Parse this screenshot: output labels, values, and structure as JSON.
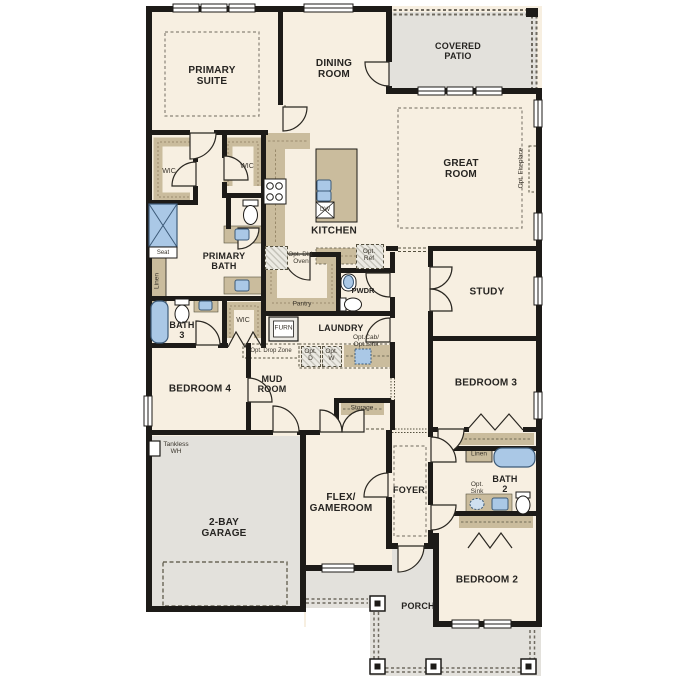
{
  "plan_title": "Single-story floor plan",
  "colors": {
    "wall": "#1d1b18",
    "floor": "#f7efe1",
    "outdoor": "#e3e1dc",
    "cabinet": "#cabc9d",
    "fixture_blue": "#aac8e6"
  },
  "rooms": {
    "primary_suite": "PRIMARY\nSUITE",
    "dining_room": "DINING\nROOM",
    "covered_patio": "COVERED\nPATIO",
    "great_room": "GREAT\nROOM",
    "kitchen": "KITCHEN",
    "primary_bath": "PRIMARY\nBATH",
    "bath_3": "BATH\n3",
    "bedroom_4": "BEDROOM 4",
    "mud_room": "MUD\nROOM",
    "laundry": "LAUNDRY",
    "pwdr": "PWDR",
    "study": "STUDY",
    "bedroom_3": "BEDROOM 3",
    "flex_gameroom": "FLEX/\nGAMEROOM",
    "foyer": "FOYER",
    "bath_2": "BATH\n2",
    "bedroom_2": "BEDROOM 2",
    "garage": "2-BAY\nGARAGE",
    "porch": "PORCH"
  },
  "closets": {
    "wic_primary_left": "WIC",
    "wic_primary_right": "WIC",
    "wic_bedroom_4": "WIC",
    "linen_primary": "Linen",
    "linen_bath_2": "Linen",
    "storage": "Storage",
    "pantry": "Pantry"
  },
  "annotations": {
    "seat": "Seat",
    "furnace": "FURN",
    "dishwasher": "DW",
    "tankless_wh": "Tankless\nWH",
    "opt_dbl_oven": "Opt. Dbl.\nOven",
    "opt_ref": "Opt.\nRef",
    "opt_drop_zone": "Opt. Drop Zone",
    "opt_d": "Opt.\nD",
    "opt_w": "Opt.\nW",
    "opt_cab_sink": "Opt.Cab/\nOpt.Sink",
    "opt_sink": "Opt.\nSink",
    "opt_fireplace": "Opt. Fireplace"
  }
}
